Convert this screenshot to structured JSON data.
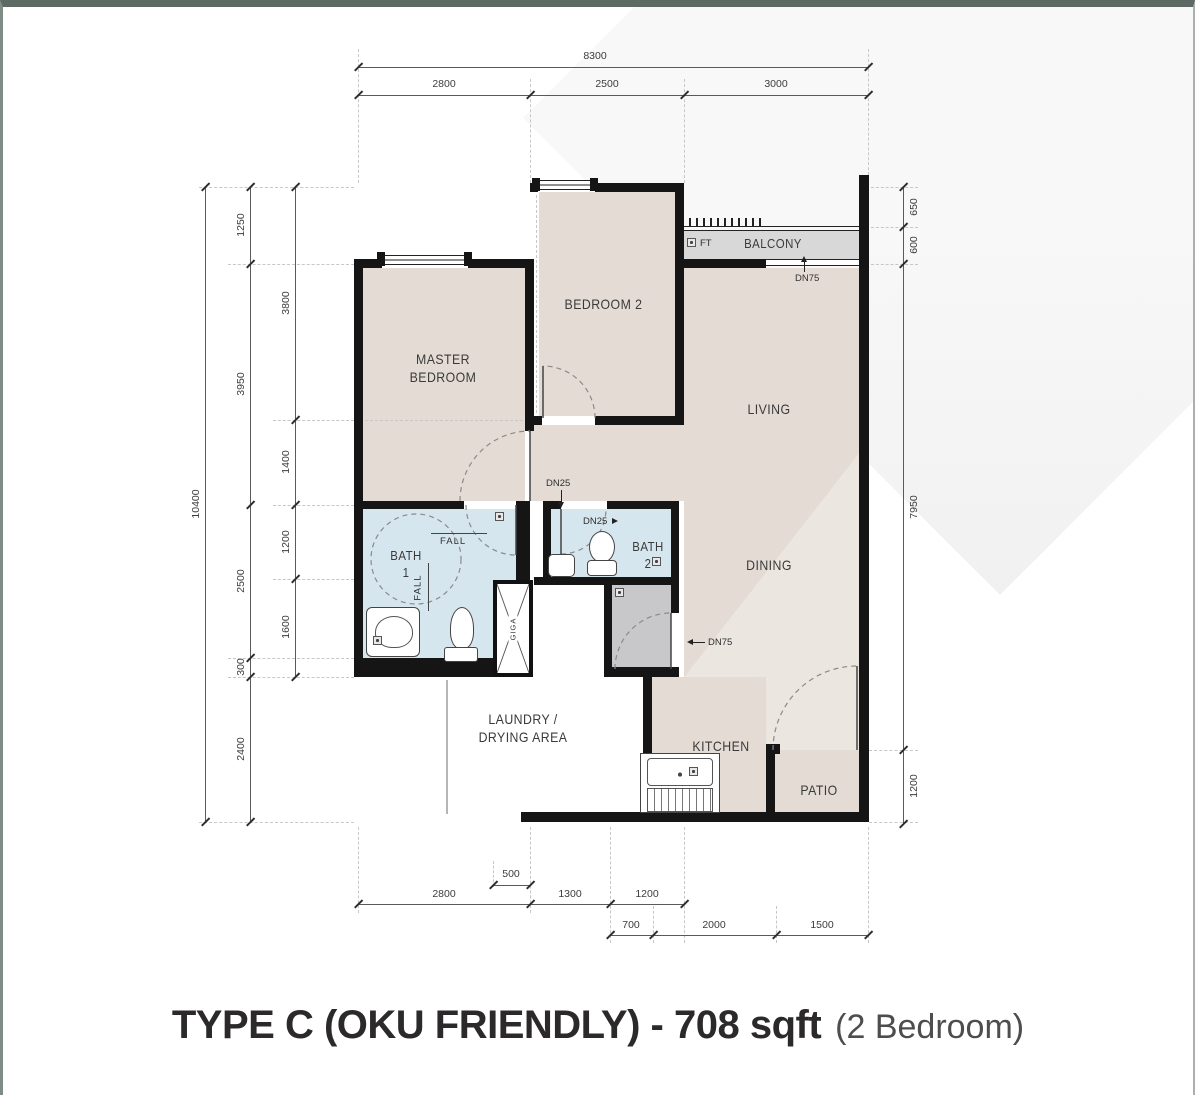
{
  "title": {
    "main": "TYPE C (OKU FRIENDLY) - 708 sqft",
    "sub": "(2 Bedroom)"
  },
  "rooms": {
    "master_line1": "MASTER",
    "master_line2": "BEDROOM",
    "bedroom2": "BEDROOM 2",
    "balcony": "BALCONY",
    "living": "LIVING",
    "dining": "DINING",
    "bath1_line1": "BATH",
    "bath1_line2": "1",
    "bath2_line1": "BATH",
    "bath2_line2": "2",
    "laundry_line1": "LAUNDRY /",
    "laundry_line2": "DRYING AREA",
    "kitchen": "KITCHEN",
    "patio": "PATIO"
  },
  "annotations": {
    "ft": "FT",
    "dn75_balcony": "DN75",
    "dn25_hall": "DN25",
    "dn25_bath2": "DN25",
    "dn75_utility": "DN75",
    "fall_a": "FALL",
    "fall_b": "FALL",
    "shaft": "GIGA"
  },
  "dimensions": {
    "top_total": "8300",
    "top": [
      "2800",
      "2500",
      "3000"
    ],
    "left_total": "10400",
    "left_outer": [
      "1250",
      "3950",
      "2500",
      "300",
      "2400"
    ],
    "left_inner": [
      "3800",
      "1400",
      "1200",
      "1600"
    ],
    "right": [
      "650",
      "600",
      "7950",
      "1200"
    ],
    "bottom_small": "500",
    "bottom_row1": [
      "2800",
      "1300",
      "1200"
    ],
    "bottom_row2": [
      "700",
      "2000",
      "1500"
    ]
  },
  "colors": {
    "wall": "#151515",
    "floor": "#e4dcd4",
    "bath": "#d6e6ef",
    "balcony": "#d8d8d8",
    "utility": "#c8c8ca",
    "title_text": "#2c292b"
  }
}
